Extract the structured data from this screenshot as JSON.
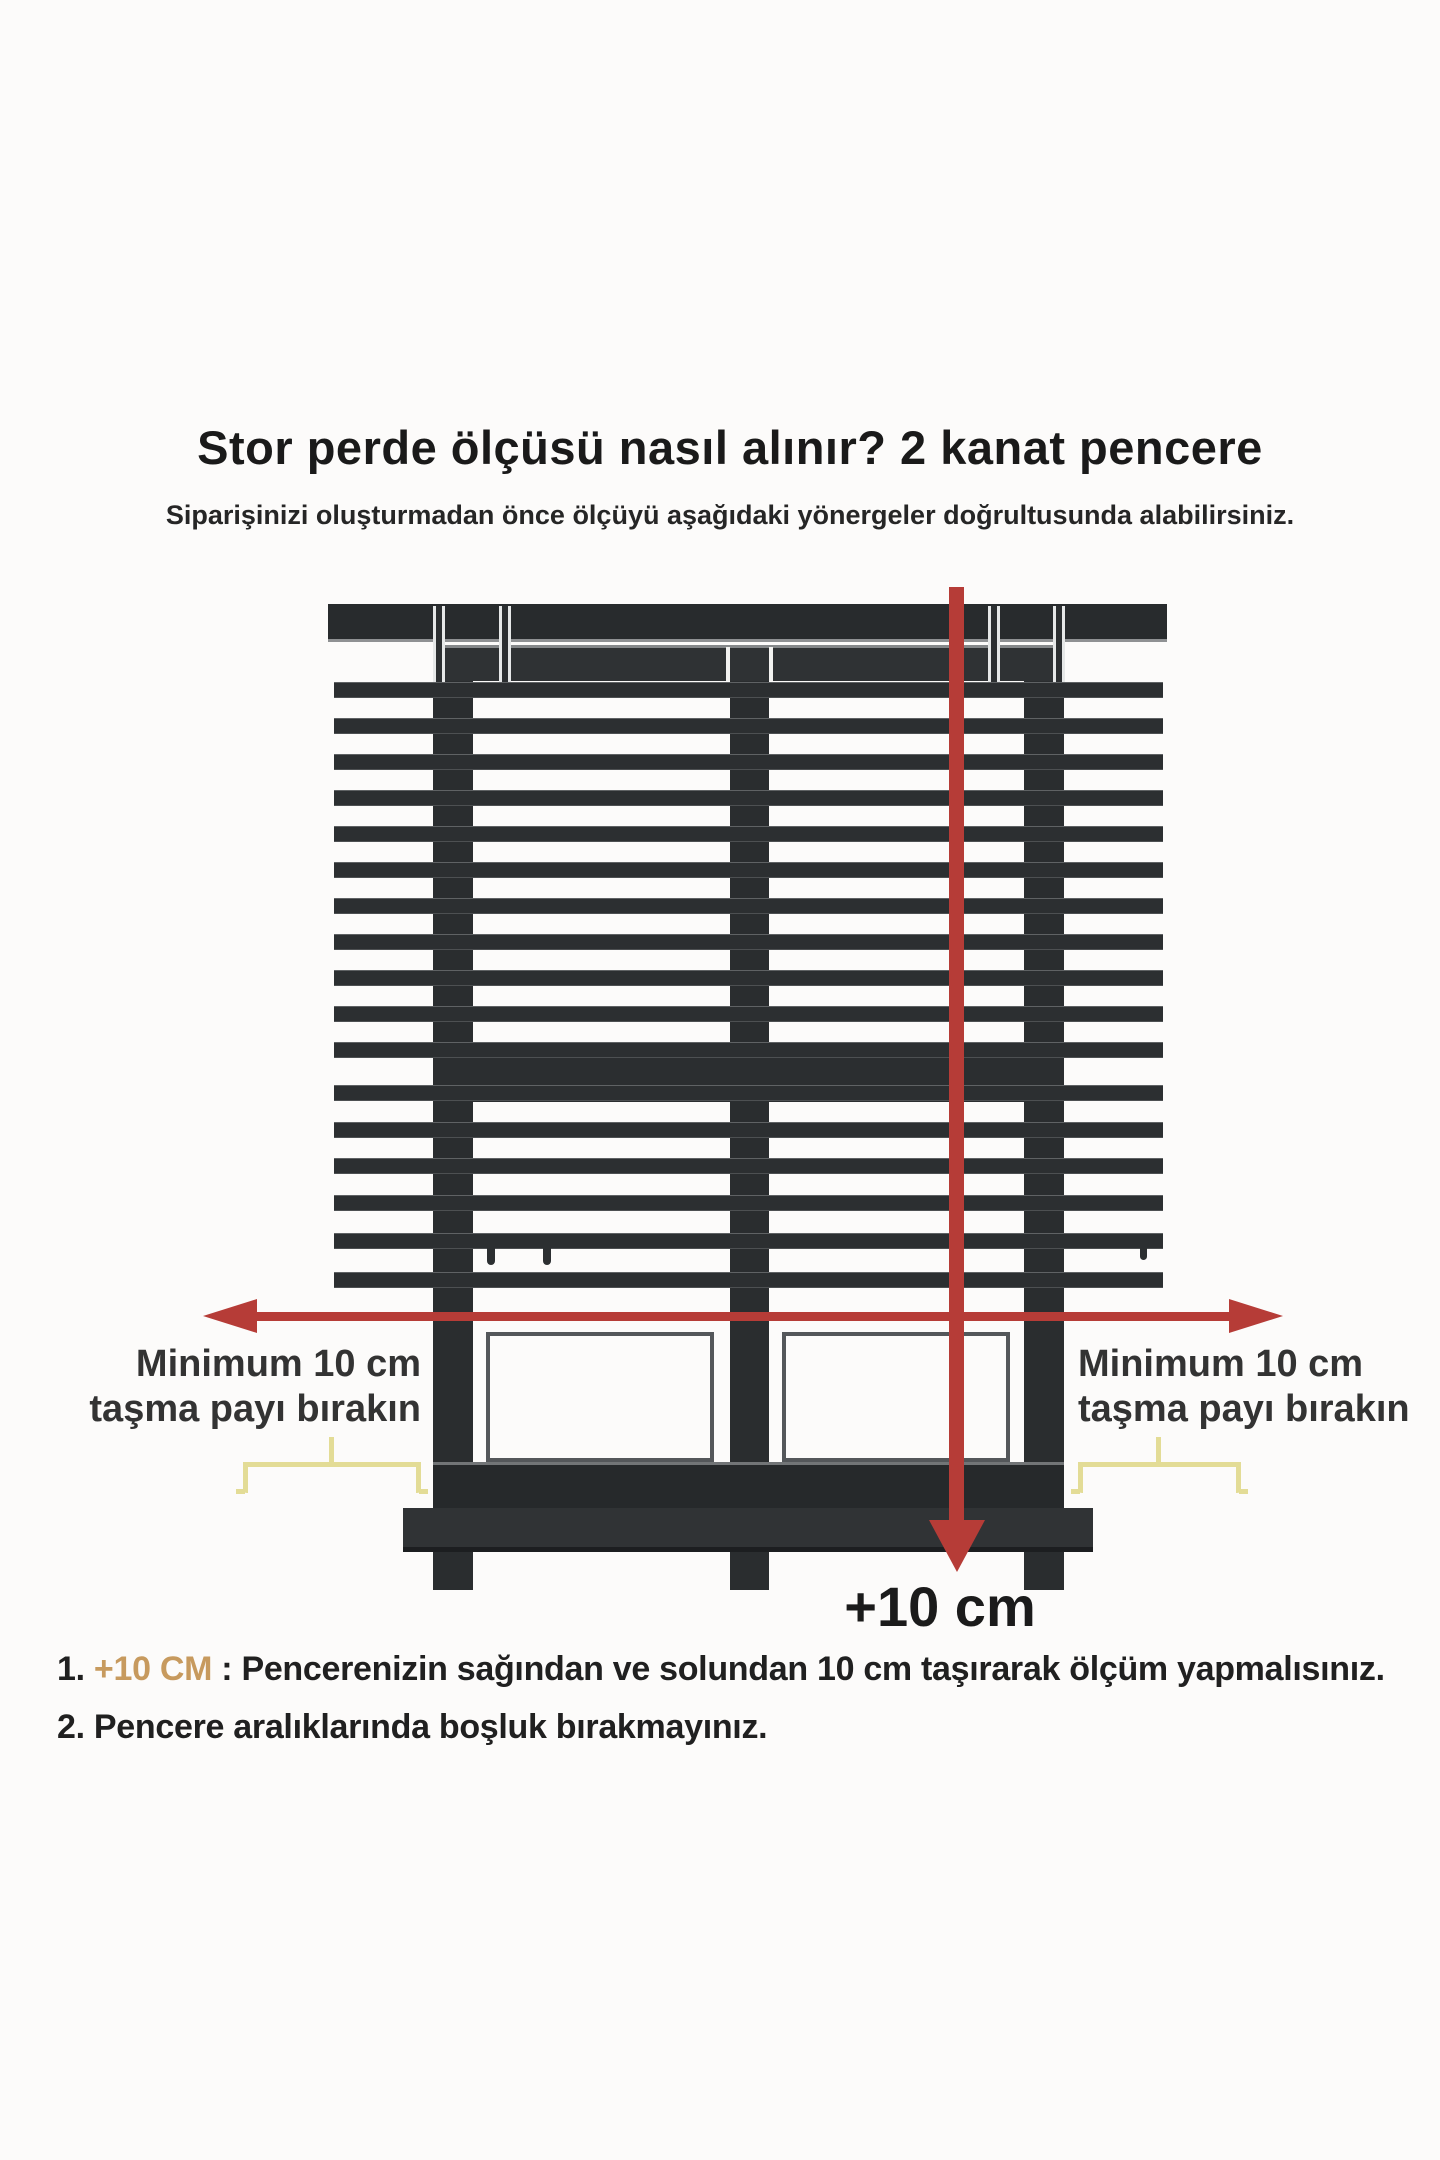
{
  "title": "Stor perde ölçüsü nasıl alınır? 2 kanat pencere",
  "subtitle": "Siparişinizi oluşturmadan önce ölçüyü aşağıdaki yönergeler doğrultusunda alabilirsiniz.",
  "measure_labels": {
    "left": {
      "line1": "Minimum 10 cm",
      "line2": "taşma payı bırakın"
    },
    "right": {
      "line1": "Minimum 10 cm",
      "line2": "taşma payı bırakın"
    },
    "bottom": "+10 cm"
  },
  "instructions": {
    "step1": {
      "num": "1.",
      "highlight": "+10 CM",
      "rest": ": Pencerenizin sağından ve solundan 10 cm taşırarak ölçüm yapmalısınız."
    },
    "step2": {
      "num": "2.",
      "rest": "Pencere aralıklarında boşluk bırakmayınız."
    }
  },
  "colors": {
    "arrow_red": "#b63c37",
    "frame_dark": "#2a2d2f",
    "slat_dark": "#2c2f31",
    "brace_yellow": "#e3dc96",
    "highlight_tan": "#c79a5e"
  }
}
